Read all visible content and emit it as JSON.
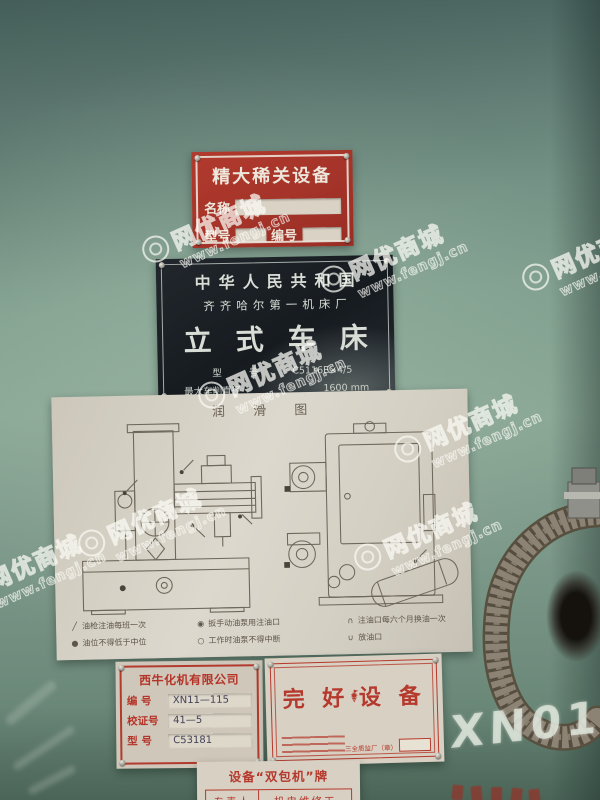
{
  "watermark": {
    "brand": "网优商城",
    "url": "www.fengj.cn"
  },
  "plates": {
    "key_equipment": {
      "title": "精大稀关设备",
      "name_label": "名称",
      "model_label": "型号",
      "serial_label": "编号"
    },
    "nameplate": {
      "country": "中华人民共和国",
      "factory": "齐齐哈尔第一机床厂",
      "product": "立式车床",
      "model_label": "型 号",
      "model_value": "C5116E×4/5",
      "diameter_label": "最大车削直径",
      "diameter_value": "1600",
      "diameter_unit": "mm",
      "serial_label": "出厂编号",
      "serial_value": "15—13",
      "made_text": "年  月制造"
    },
    "lubrication": {
      "title": "润 滑 图",
      "legend": [
        {
          "symbol": "╱",
          "text": "油枪注油每班一次"
        },
        {
          "symbol": "◉",
          "text": "扳手动油泵用注油口"
        },
        {
          "symbol": "∩",
          "text": "注油口每六个月换油一次"
        },
        {
          "symbol": "●",
          "text": "油位不得低于中位"
        },
        {
          "symbol": "○",
          "text": "工作时油泵不得中断"
        },
        {
          "symbol": "∪",
          "text": "放油口"
        }
      ]
    },
    "company": {
      "title": "西牛化机有限公司",
      "rows": [
        {
          "label": "编 号",
          "value": "XN11—115"
        },
        {
          "label": "校证号",
          "value": "41—5"
        },
        {
          "label": "型 号",
          "value": "C53181"
        }
      ]
    },
    "good_condition": {
      "left_word": "完 好",
      "right_word": "设 备",
      "stamp_label": "三全质监厂（章）"
    },
    "dual_duty": {
      "title": "设备“双包机”牌",
      "cells": [
        "专责人",
        "机电维修工"
      ]
    }
  },
  "graffiti": {
    "chalk": "XN01"
  }
}
